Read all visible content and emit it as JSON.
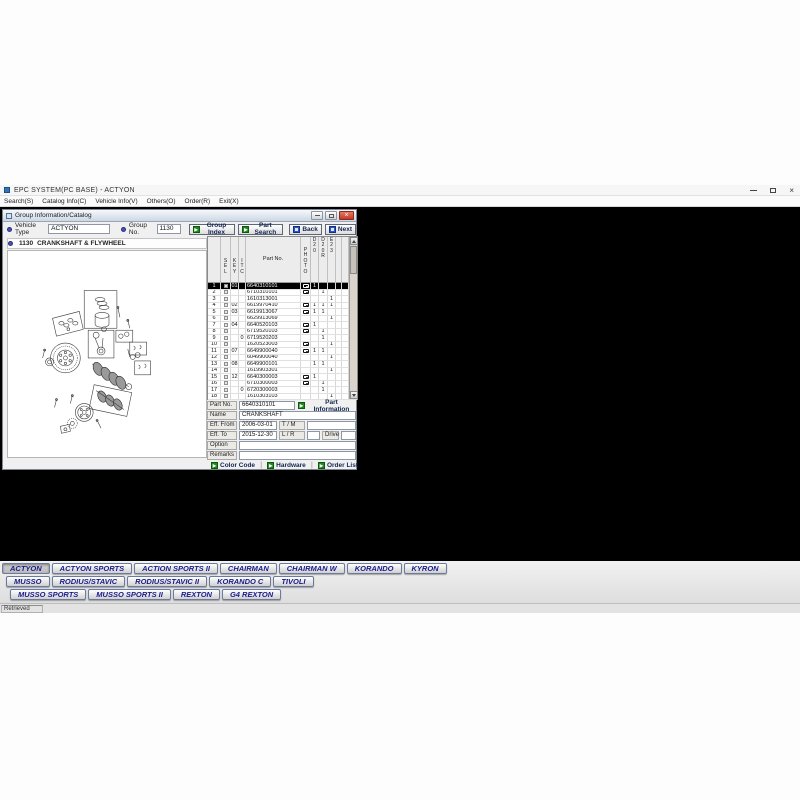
{
  "app": {
    "title": "EPC SYSTEM(PC BASE) - ACTYON",
    "menus": [
      "Search(S)",
      "Catalog Info(C)",
      "Vehicle Info(V)",
      "Others(O)",
      "Order(R)",
      "Exit(X)"
    ],
    "status": "Retrieved"
  },
  "catalog_window": {
    "title": "Group Information/Catalog",
    "toolbar": {
      "vehicle_type_label": "Vehicle Type",
      "vehicle_type_value": "ACTYON",
      "group_no_label": "Group No.",
      "group_no_value": "1130",
      "group_index_label": "Group Index",
      "part_search_label": "Part Search",
      "back_label": "Back",
      "next_label": "Next"
    },
    "section": {
      "code": "1130",
      "name": "CRANKSHAFT & FLYWHEEL"
    },
    "parts_table": {
      "columns": [
        {
          "id": "no",
          "label": ""
        },
        {
          "id": "sel",
          "label": "SEL",
          "vertical": true,
          "pos": "mid"
        },
        {
          "id": "key",
          "label": "KEY",
          "vertical": true,
          "pos": "mid"
        },
        {
          "id": "itc",
          "label": "ITC",
          "vertical": true,
          "pos": "mid"
        },
        {
          "id": "part",
          "label": "Part No."
        },
        {
          "id": "photo",
          "label": "PHOTO",
          "vertical": true,
          "pos": "mid"
        },
        {
          "id": "d20",
          "label": "D20",
          "vertical": true,
          "pos": "top"
        },
        {
          "id": "d20r",
          "label": "D20R",
          "vertical": true,
          "pos": "top"
        },
        {
          "id": "e23",
          "label": "E23",
          "vertical": true,
          "pos": "top"
        },
        {
          "id": "x1",
          "label": ""
        },
        {
          "id": "x2",
          "label": ""
        }
      ],
      "rows": [
        {
          "no": "1",
          "sel": true,
          "key": "01",
          "itc": "",
          "part": "6640310101",
          "photo": true,
          "d20": "1",
          "d20r": "",
          "e23": "",
          "selected": true
        },
        {
          "no": "2",
          "sel": true,
          "key": "",
          "itc": "",
          "part": "6710310101",
          "photo": true,
          "d20": "",
          "d20r": "1",
          "e23": ""
        },
        {
          "no": "3",
          "sel": true,
          "key": "",
          "itc": "",
          "part": "1610313001",
          "photo": false,
          "d20": "",
          "d20r": "",
          "e23": "1"
        },
        {
          "no": "4",
          "sel": true,
          "key": "02",
          "itc": "",
          "part": "6619970410",
          "photo": true,
          "d20": "1",
          "d20r": "1",
          "e23": "1"
        },
        {
          "no": "5",
          "sel": true,
          "key": "03",
          "itc": "",
          "part": "6619913067",
          "photo": true,
          "d20": "1",
          "d20r": "1",
          "e23": ""
        },
        {
          "no": "6",
          "sel": true,
          "key": "",
          "itc": "",
          "part": "6629913069",
          "photo": false,
          "d20": "",
          "d20r": "",
          "e23": "1"
        },
        {
          "no": "7",
          "sel": true,
          "key": "04",
          "itc": "",
          "part": "6640520103",
          "photo": true,
          "d20": "1",
          "d20r": "",
          "e23": ""
        },
        {
          "no": "8",
          "sel": true,
          "key": "",
          "itc": "",
          "part": "6719520103",
          "photo": true,
          "d20": "",
          "d20r": "1",
          "e23": ""
        },
        {
          "no": "9",
          "sel": true,
          "key": "",
          "itc": "0",
          "part": "6719520203",
          "photo": false,
          "d20": "",
          "d20r": "1",
          "e23": ""
        },
        {
          "no": "10",
          "sel": true,
          "key": "",
          "itc": "",
          "part": "1620523003",
          "photo": true,
          "d20": "",
          "d20r": "",
          "e23": "1"
        },
        {
          "no": "11",
          "sel": true,
          "key": "07",
          "itc": "",
          "part": "6649900040",
          "photo": true,
          "d20": "1",
          "d20r": "1",
          "e23": ""
        },
        {
          "no": "12",
          "sel": true,
          "key": "",
          "itc": "",
          "part": "6049900040",
          "photo": false,
          "d20": "",
          "d20r": "",
          "e23": "1"
        },
        {
          "no": "13",
          "sel": true,
          "key": "08",
          "itc": "",
          "part": "6649900101",
          "photo": false,
          "d20": "1",
          "d20r": "1",
          "e23": ""
        },
        {
          "no": "14",
          "sel": true,
          "key": "",
          "itc": "",
          "part": "1619903301",
          "photo": false,
          "d20": "",
          "d20r": "",
          "e23": "1"
        },
        {
          "no": "15",
          "sel": true,
          "key": "12",
          "itc": "",
          "part": "6640300003",
          "photo": true,
          "d20": "1",
          "d20r": "",
          "e23": ""
        },
        {
          "no": "16",
          "sel": true,
          "key": "",
          "itc": "",
          "part": "6710300003",
          "photo": true,
          "d20": "",
          "d20r": "1",
          "e23": ""
        },
        {
          "no": "17",
          "sel": true,
          "key": "",
          "itc": "0",
          "part": "6720300003",
          "photo": false,
          "d20": "",
          "d20r": "1",
          "e23": ""
        },
        {
          "no": "18",
          "sel": true,
          "key": "",
          "itc": "",
          "part": "1610303103",
          "photo": false,
          "d20": "",
          "d20r": "",
          "e23": "1"
        }
      ]
    },
    "detail": {
      "part_no_label": "Part No.",
      "part_no_value": "6640310101",
      "part_information_label": "Part Information",
      "name_label": "Name",
      "name_value": "CRANKSHAFT",
      "eff_from_label": "Eff. From",
      "eff_from_value": "2006-03-01",
      "tm_label": "T / M",
      "tm_value": "",
      "eff_to_label": "Eff. To",
      "eff_to_value": "2015-12-30",
      "lr_label": "L / R",
      "lr_value": "",
      "drive_label": "Drive",
      "drive_value": "",
      "option_label": "Option",
      "option_value": "",
      "remarks_label": "Remarks",
      "remarks_value": "",
      "color_code_label": "Color Code",
      "hardware_label": "Hardware",
      "order_list_label": "Order List"
    }
  },
  "model_buttons": {
    "rows": [
      [
        "ACTYON",
        "ACTYON SPORTS",
        "ACTION SPORTS II",
        "CHAIRMAN",
        "CHAIRMAN W",
        "KORANDO",
        "KYRON"
      ],
      [
        "MUSSO",
        "RODIUS/STAVIC",
        "RODIUS/STAVIC II",
        "KORANDO C",
        "TIVOLI"
      ],
      [
        "MUSSO SPORTS",
        "MUSSO SPORTS II",
        "REXTON",
        "G4 REXTON"
      ]
    ],
    "active": "ACTYON"
  },
  "icons": {
    "green_button_glyph": "▶",
    "close_glyph": "×"
  },
  "colors": {
    "accent_green": "#1e8a1e",
    "accent_blue": "#2b55c8",
    "close_red": "#c23a28",
    "model_text_navy": "#1a1a8c",
    "selection_bg": "#000000",
    "client_bg": "#000000"
  }
}
